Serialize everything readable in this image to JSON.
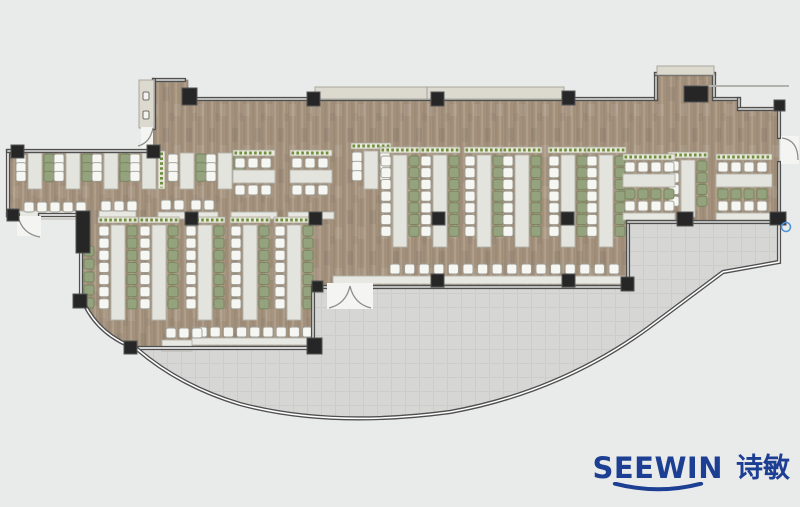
{
  "canvas": {
    "width": 800,
    "height": 507
  },
  "brand": {
    "latin": "SEEWIN",
    "cjk": "诗敏"
  },
  "colors": {
    "bg": "#e9eaea",
    "floor": "#a4927e",
    "floor_dark": "#94826d",
    "floor_light": "#b4a490",
    "terrace": "#d6d7d5",
    "terrace_line": "#cccdca",
    "wall": "#4f4f4f",
    "wall_inner": "#dddddb",
    "column": "#262626",
    "desk": "#e4e4de",
    "desk_stroke": "#b3b3aa",
    "counter": "#e8e8e2",
    "chair_white": "#f6f6f2",
    "chair_white_stroke": "#9d9d95",
    "chair_green": "#94a37d",
    "chair_green_stroke": "#75855d",
    "planter": "#eae8da",
    "planter_stroke": "#a9a699",
    "planter_green": "#6d8f3e",
    "band": "#dcd9cf",
    "brand": "#1c3f93"
  },
  "plan": {
    "floor_path": "M153,80 L188,80 L188,99 L656,99 L656,74 L714,74 L714,99 L739,99 L739,109 L779,109 L779,222 L628,222 L628,287 L313,287 L313,348 L137,348 Q95,334 81,296 L81,215 L8,215 L8,151 L153,151 Z",
    "terrace_path": "M137,348 L313,348 L313,287 L628,287 L628,222 L779,222 L779,262 L723,272 L648,328 Q560,392 450,412 Q330,428 240,404 Q180,386 137,348 Z",
    "walls_solid": [
      "M154,80 H184",
      "M188,99 H656",
      "M656,99 V74",
      "M656,74 H714",
      "M714,74 V99",
      "M714,99 H739",
      "M739,99 V109",
      "M739,109 H779",
      "M779,109 V137",
      "M779,163 V222",
      "M154,80 V128",
      "M154,148 V152",
      "M8,151 H153",
      "M313,287 H327",
      "M373,287 H628",
      "M628,287 V222",
      "M628,222 H779",
      "M313,349 V287"
    ],
    "walls_glass": [
      "M8,151 V215",
      "M8,215 H18",
      "M40,215 H77",
      "M81,215 V296",
      "M81,296 Q95,334 137,349",
      "M137,348 H313",
      "M779,222 V262 L723,272 L648,328 Q560,392 450,412 Q330,428 240,404 Q180,386 137,349"
    ],
    "ne_line": "M700,86 H789",
    "bands": [
      {
        "x": 315,
        "y": 87,
        "w": 249,
        "h": 12,
        "name": "top-planter-ledge"
      },
      {
        "x": 657,
        "y": 66,
        "w": 57,
        "h": 9,
        "name": "bump-ledge"
      },
      {
        "x": 139,
        "y": 80,
        "w": 15,
        "h": 48,
        "name": "louver-unit"
      }
    ],
    "band_seams": [
      "M427,87 V99"
    ],
    "louver_dots": [
      [
        143,
        92,
        6,
        8
      ],
      [
        143,
        111,
        6,
        8
      ]
    ],
    "columns": [
      [
        182,
        88,
        15,
        17
      ],
      [
        307,
        92,
        13,
        14
      ],
      [
        431,
        92,
        13,
        14
      ],
      [
        562,
        91,
        13,
        14
      ],
      [
        684,
        86,
        24,
        16
      ],
      [
        774,
        100,
        11,
        11
      ],
      [
        11,
        145,
        13,
        13
      ],
      [
        147,
        145,
        13,
        13
      ],
      [
        7,
        209,
        12,
        12
      ],
      [
        76,
        211,
        14,
        42
      ],
      [
        185,
        212,
        13,
        13
      ],
      [
        309,
        212,
        13,
        13
      ],
      [
        432,
        212,
        13,
        13
      ],
      [
        561,
        212,
        13,
        13
      ],
      [
        312,
        281,
        11,
        11
      ],
      [
        431,
        274,
        13,
        13
      ],
      [
        562,
        274,
        13,
        13
      ],
      [
        621,
        277,
        13,
        14
      ],
      [
        677,
        212,
        16,
        14
      ],
      [
        770,
        212,
        16,
        13
      ],
      [
        124,
        341,
        13,
        13
      ],
      [
        307,
        338,
        15,
        16
      ],
      [
        73,
        294,
        14,
        14
      ]
    ],
    "vruns": [
      {
        "x": 28,
        "y": 153,
        "h": 36,
        "n": 3,
        "left": "white",
        "right": "green",
        "planter": false
      },
      {
        "x": 66,
        "y": 153,
        "h": 36,
        "n": 3,
        "left": "white",
        "right": "green",
        "planter": false
      },
      {
        "x": 104,
        "y": 153,
        "h": 36,
        "n": 3,
        "left": "white",
        "right": "green",
        "planter": false
      },
      {
        "x": 142,
        "y": 153,
        "h": 36,
        "n": 3,
        "left": "white",
        "right": "planter",
        "planter": false
      },
      {
        "x": 180,
        "y": 153,
        "h": 36,
        "n": 3,
        "left": "white",
        "right": "green",
        "planter": false
      },
      {
        "x": 218,
        "y": 153,
        "h": 36,
        "n": 3,
        "left": "white",
        "right": "green",
        "planter": false
      },
      {
        "x": 364,
        "y": 151,
        "h": 38,
        "n": 3,
        "left": "white",
        "right": "white",
        "planter": true
      },
      {
        "x": 393,
        "y": 155,
        "h": 92,
        "n": 7,
        "left": "white",
        "right": "green",
        "planter": true
      },
      {
        "x": 433,
        "y": 155,
        "h": 92,
        "n": 7,
        "left": "white",
        "right": "green",
        "planter": true
      },
      {
        "x": 477,
        "y": 155,
        "h": 92,
        "n": 7,
        "left": "white",
        "right": "green",
        "planter": true
      },
      {
        "x": 515,
        "y": 155,
        "h": 92,
        "n": 7,
        "left": "white",
        "right": "green",
        "planter": true
      },
      {
        "x": 561,
        "y": 155,
        "h": 92,
        "n": 7,
        "left": "white",
        "right": "green",
        "planter": true
      },
      {
        "x": 599,
        "y": 155,
        "h": 92,
        "n": 7,
        "left": "white",
        "right": "green",
        "planter": true
      },
      {
        "x": 111,
        "y": 225,
        "h": 95,
        "n": 7,
        "left": "white",
        "right": "green",
        "planter": true
      },
      {
        "x": 152,
        "y": 225,
        "h": 95,
        "n": 7,
        "left": "white",
        "right": "green",
        "planter": true
      },
      {
        "x": 198,
        "y": 225,
        "h": 95,
        "n": 7,
        "left": "white",
        "right": "green",
        "planter": true
      },
      {
        "x": 243,
        "y": 225,
        "h": 95,
        "n": 7,
        "left": "white",
        "right": "green",
        "planter": true
      },
      {
        "x": 287,
        "y": 225,
        "h": 95,
        "n": 7,
        "left": "white",
        "right": "green",
        "planter": true
      },
      {
        "x": 681,
        "y": 160,
        "h": 57,
        "n": 4,
        "left": "white",
        "right": "green",
        "planter": true
      }
    ],
    "hclusters": [
      {
        "x": 233,
        "y": 150,
        "w": 42,
        "rows": [
          "planter",
          "white",
          "desk",
          "white"
        ]
      },
      {
        "x": 290,
        "y": 150,
        "w": 42,
        "rows": [
          "planter",
          "white",
          "desk",
          "white"
        ]
      },
      {
        "x": 623,
        "y": 154,
        "w": 52,
        "rows": [
          "planter",
          "white",
          "desk",
          "green",
          "white",
          "counter"
        ]
      },
      {
        "x": 716,
        "y": 154,
        "w": 56,
        "rows": [
          "planter",
          "white",
          "desk",
          "green",
          "white",
          "counter"
        ]
      }
    ],
    "stool_rows": [
      [
        24,
        202,
        5,
        13
      ],
      [
        101,
        201,
        3,
        13
      ],
      [
        161,
        200,
        2,
        13
      ],
      [
        191,
        200,
        2,
        13
      ],
      [
        390,
        264,
        16,
        14.6
      ],
      [
        197,
        327,
        9,
        13.2
      ],
      [
        166,
        328,
        3,
        13
      ]
    ],
    "chair_cols": [
      {
        "x": 84,
        "y": 246,
        "n": 5,
        "dy": 13,
        "color": "green"
      }
    ],
    "counters": [
      [
        18,
        211,
        61,
        8
      ],
      [
        99,
        211,
        37,
        8
      ],
      [
        158,
        212,
        28,
        7
      ],
      [
        188,
        212,
        30,
        7
      ],
      [
        231,
        212,
        46,
        7
      ],
      [
        288,
        212,
        46,
        7
      ],
      [
        333,
        276,
        292,
        8
      ],
      [
        192,
        338,
        118,
        7
      ],
      [
        162,
        340,
        30,
        11
      ]
    ],
    "planters_v": [
      [
        158,
        151,
        7,
        38
      ]
    ],
    "doors": [
      {
        "name": "entrance-double-door",
        "rect": [
          327,
          283,
          46,
          26
        ],
        "arcs": [
          "M350,286 Q346,304 329,308",
          "M350,286 Q354,304 371,308"
        ]
      },
      {
        "name": "door-right",
        "rect": [
          781,
          136,
          18,
          28
        ],
        "arcs": [
          "M782,138 Q798,140 798,160"
        ]
      },
      {
        "name": "door-top-left",
        "rect": [
          141,
          127,
          12,
          21
        ],
        "arcs": [
          "M153,128 Q150,143 138,146"
        ]
      },
      {
        "name": "door-wing",
        "rect": [
          17,
          216,
          24,
          20
        ],
        "arcs": [
          "M18,216 Q22,234 40,237"
        ]
      }
    ],
    "marker": {
      "cx": 786,
      "cy": 227,
      "r": 4.5
    }
  }
}
